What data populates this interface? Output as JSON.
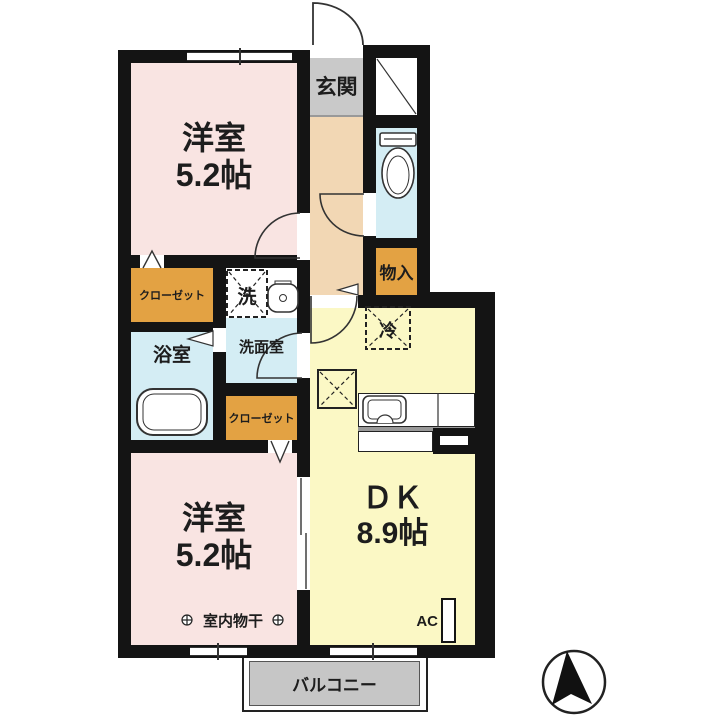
{
  "floorplan": {
    "rooms": {
      "bedroom_top": {
        "name": "洋室",
        "size": "5.2帖"
      },
      "bedroom_bottom": {
        "name": "洋室",
        "size": "5.2帖"
      },
      "dk": {
        "name": "ＤＫ",
        "size": "8.9帖"
      },
      "entrance": {
        "label": "玄関"
      },
      "washroom": {
        "label": "洗面室"
      },
      "bathroom": {
        "label": "浴室"
      },
      "storage": {
        "label": "物入"
      },
      "closet_top": {
        "label": "クローゼット"
      },
      "closet_bottom": {
        "label": "クローゼット"
      },
      "balcony": {
        "label": "バルコニー"
      }
    },
    "fixtures": {
      "washer_label": "洗",
      "fridge_label": "冷",
      "ac_label": "AC",
      "indoor_drying_label": "室内物干"
    },
    "icons": {
      "compass": "north-arrow"
    },
    "colors": {
      "room_pink": "#f9e4e2",
      "hallway_tan": "#f2d7b4",
      "entrance_gray": "#c9c9c9",
      "wet_area_cyan": "#d4edf4",
      "closet_orange": "#e3a243",
      "dk_yellow": "#fbf8c5",
      "balcony_gray": "#c6c6c6",
      "wall_black": "#141414"
    }
  }
}
